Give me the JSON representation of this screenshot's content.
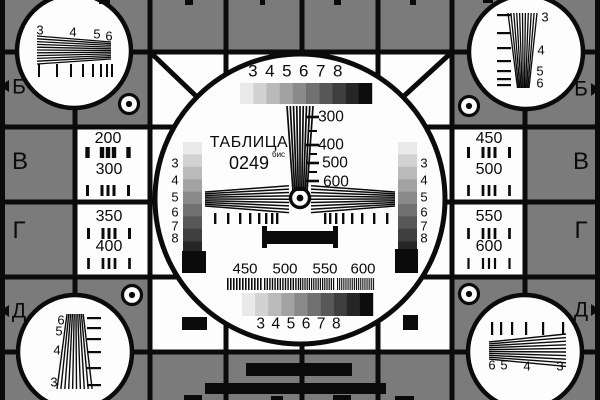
{
  "colors": {
    "bg": "#7b7b7b",
    "white": "#fdfdfd",
    "black": "#0b0b0b"
  },
  "scales": {
    "grays": [
      "#e9e9e9",
      "#d2d2d2",
      "#bababa",
      "#a2a2a2",
      "#8a8a8a",
      "#717171",
      "#585858",
      "#3f3f3f",
      "#262626",
      "#0d0d0d"
    ],
    "side_digits": [
      "3",
      "4",
      "5",
      "6",
      "7",
      "8"
    ]
  },
  "center": {
    "title": "ТАБЛИЦА",
    "code": "0249",
    "code_sup": "бис",
    "top_digits": "3 4 5 6 7 8",
    "bottom_digits": "3 4 5 6 7 8",
    "wedge_labels": [
      "300",
      "400",
      "500",
      "600"
    ],
    "burst_labels": [
      "450",
      "500",
      "550",
      "600"
    ]
  },
  "panels": {
    "left": {
      "rows": [
        {
          "letter": "В",
          "f1": "200",
          "f2": "300"
        },
        {
          "letter": "Г",
          "f1": "350",
          "f2": "400"
        }
      ]
    },
    "right": {
      "rows": [
        {
          "letter": "В",
          "f1": "450",
          "f2": "500"
        },
        {
          "letter": "Г",
          "f1": "550",
          "f2": "600"
        }
      ]
    }
  },
  "edges": {
    "left_top": "Б",
    "right_top": "Б",
    "left_bottom": "Д",
    "right_bottom": "Д"
  },
  "corners": {
    "top_left": {
      "digits": [
        "3",
        "4",
        "5",
        "6"
      ]
    },
    "top_right": {
      "digits": [
        "3",
        "4",
        "5",
        "6"
      ]
    },
    "bottom_left": {
      "digits": [
        "6",
        "5",
        "4",
        "3"
      ]
    },
    "bottom_right": {
      "digits": [
        "6",
        "5",
        "4",
        "3"
      ]
    }
  }
}
